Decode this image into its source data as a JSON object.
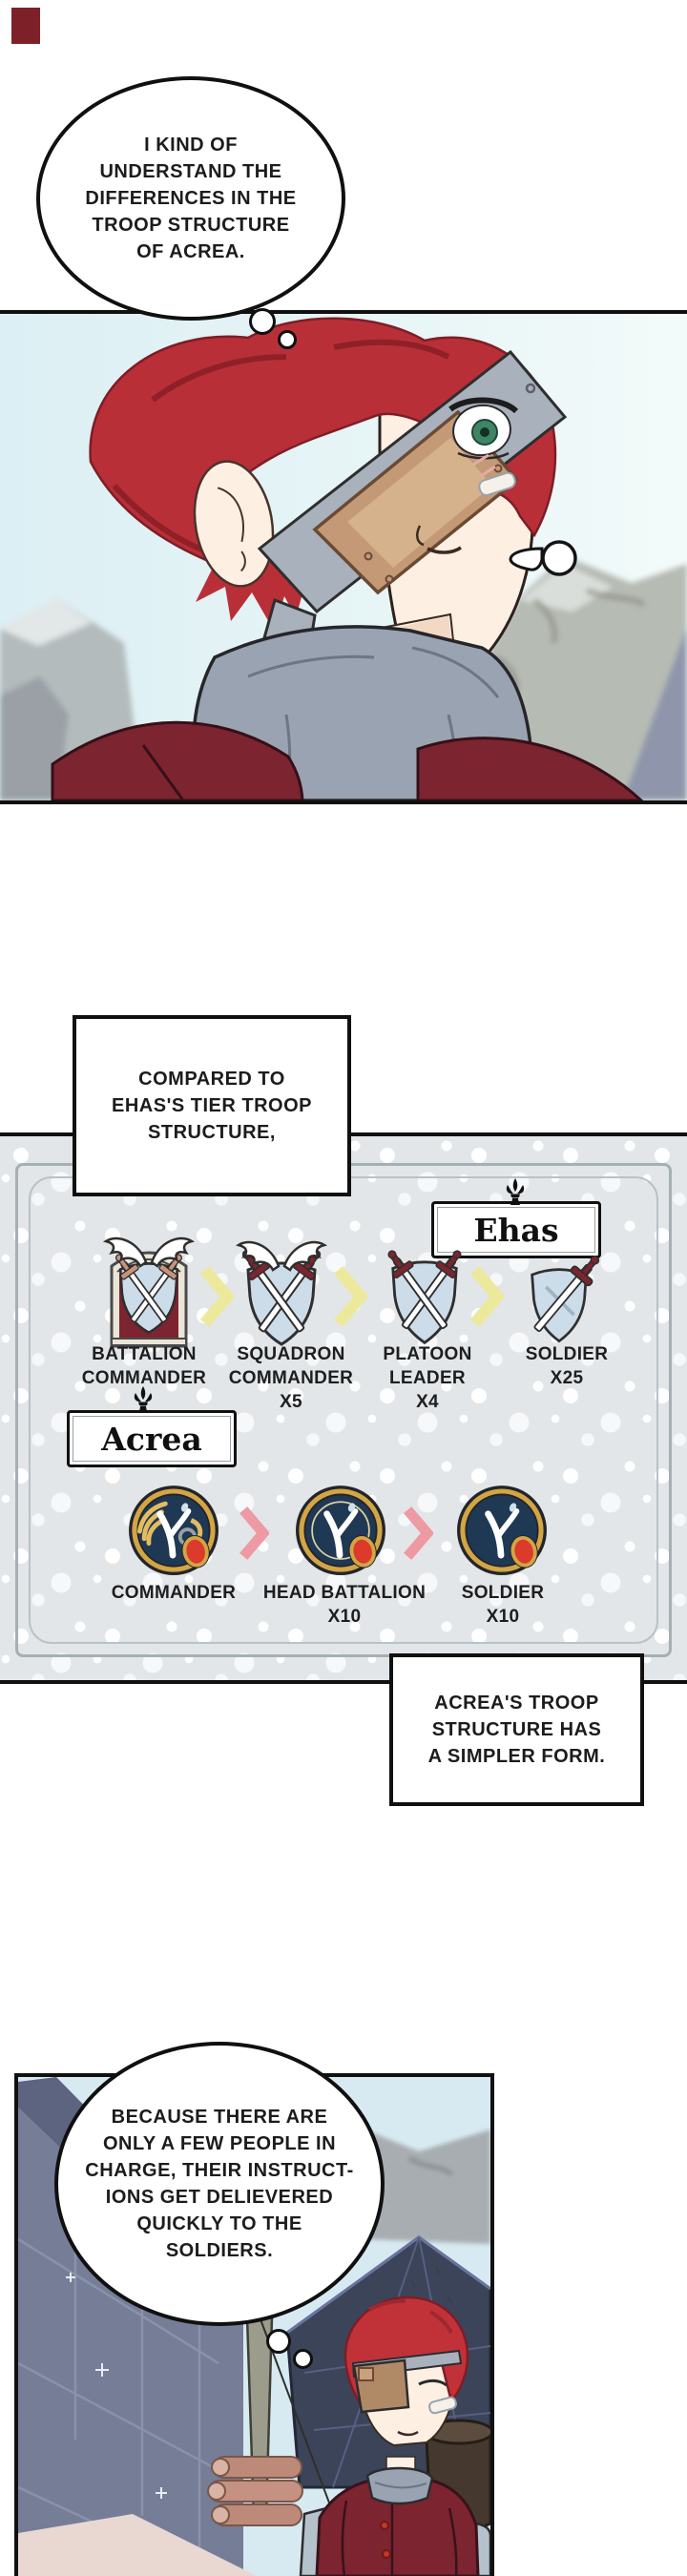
{
  "colors": {
    "panel_border": "#101010",
    "sky_blue": "#def0f4",
    "mountain_gray": "#b3b9b6",
    "hair_red": "#b92f38",
    "jacket_maroon": "#7c2430",
    "collar_gray": "#9aa3b2",
    "eyepatch_tan": "#c49a76",
    "strap_gray": "#a9b1bc",
    "pattern_bg": "#e2e6e8",
    "frame_line": "#a6b0b4",
    "chevron_yellow": "#ece99c",
    "chevron_pink": "#ee9aa3",
    "shield_blue": "#ccdce8",
    "badge_navy": "#1f3854",
    "badge_gold": "#d2a545",
    "seal_red": "#dc3a2b",
    "wall_blue_gray": "#767d97",
    "tent_navy": "#3c4459",
    "log_pink": "#bd8a79",
    "ground_pink": "#e9d8d2"
  },
  "thought_bubble_1": {
    "lines": [
      "I KIND OF",
      "UNDERSTAND THE",
      "DIFFERENCES IN THE",
      "TROOP STRUCTURE",
      "OF ACREA."
    ]
  },
  "caption_compared": {
    "lines": [
      "COMPARED TO",
      "EHAS'S TIER TROOP",
      "STRUCTURE,"
    ]
  },
  "caption_simpler": {
    "lines": [
      "ACREA'S TROOP",
      "STRUCTURE HAS",
      "A SIMPLER FORM."
    ]
  },
  "thought_bubble_2": {
    "lines": [
      "BECAUSE THERE ARE",
      "ONLY A FEW PEOPLE IN",
      "CHARGE, THEIR INSTRUCT-",
      "IONS GET DELIEVERED",
      "QUICKLY TO THE",
      "SOLDIERS."
    ]
  },
  "diagram": {
    "ehas": {
      "name": "Ehas",
      "arrow_icon": "yellow-chevron",
      "ranks": [
        {
          "icon": "winged-crest-arch-shield",
          "lines": [
            "BATTALION",
            "COMMANDER"
          ]
        },
        {
          "icon": "winged-crossed-swords-shield",
          "lines": [
            "SQUADRON",
            "COMMANDER",
            "X5"
          ]
        },
        {
          "icon": "crossed-swords-shield",
          "lines": [
            "PLATOON",
            "LEADER",
            "X4"
          ]
        },
        {
          "icon": "single-sword-shield",
          "lines": [
            "SOLDIER",
            "X25"
          ]
        }
      ]
    },
    "acrea": {
      "name": "Acrea",
      "arrow_icon": "pink-chevron",
      "ranks": [
        {
          "icon": "ornate-falcon-badge",
          "lines": [
            "COMMANDER"
          ]
        },
        {
          "icon": "ringed-falcon-badge",
          "lines": [
            "HEAD BATTALION",
            "X10"
          ]
        },
        {
          "icon": "falcon-badge",
          "lines": [
            "SOLDIER",
            "X10"
          ]
        }
      ]
    }
  }
}
